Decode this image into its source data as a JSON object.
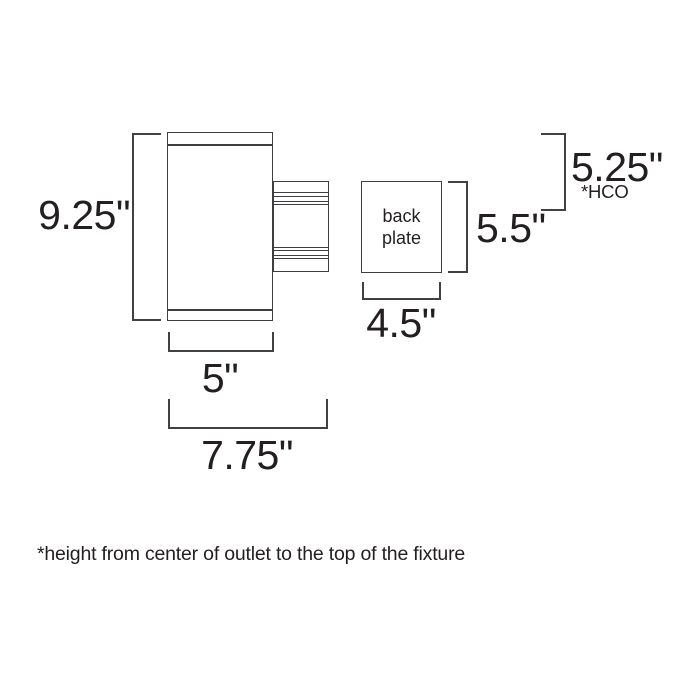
{
  "diagram": {
    "title_hint": "wall fixture dimension drawing",
    "labels": {
      "fixture_height": "9.25\"",
      "fixture_width": "5\"",
      "overall_depth": "7.75\"",
      "backplate_width": "4.5\"",
      "backplate_height": "5.5\"",
      "hco": "5.25\"",
      "hco_abbrev": "*HCO"
    },
    "backplate": {
      "line1": "back",
      "line2": "plate"
    },
    "footnote": "*height from center of outlet to the top of the fixture",
    "colors": {
      "line": "#3f3e40",
      "bracket": "#414042",
      "text": "#231f20",
      "background": "#ffffff"
    }
  }
}
